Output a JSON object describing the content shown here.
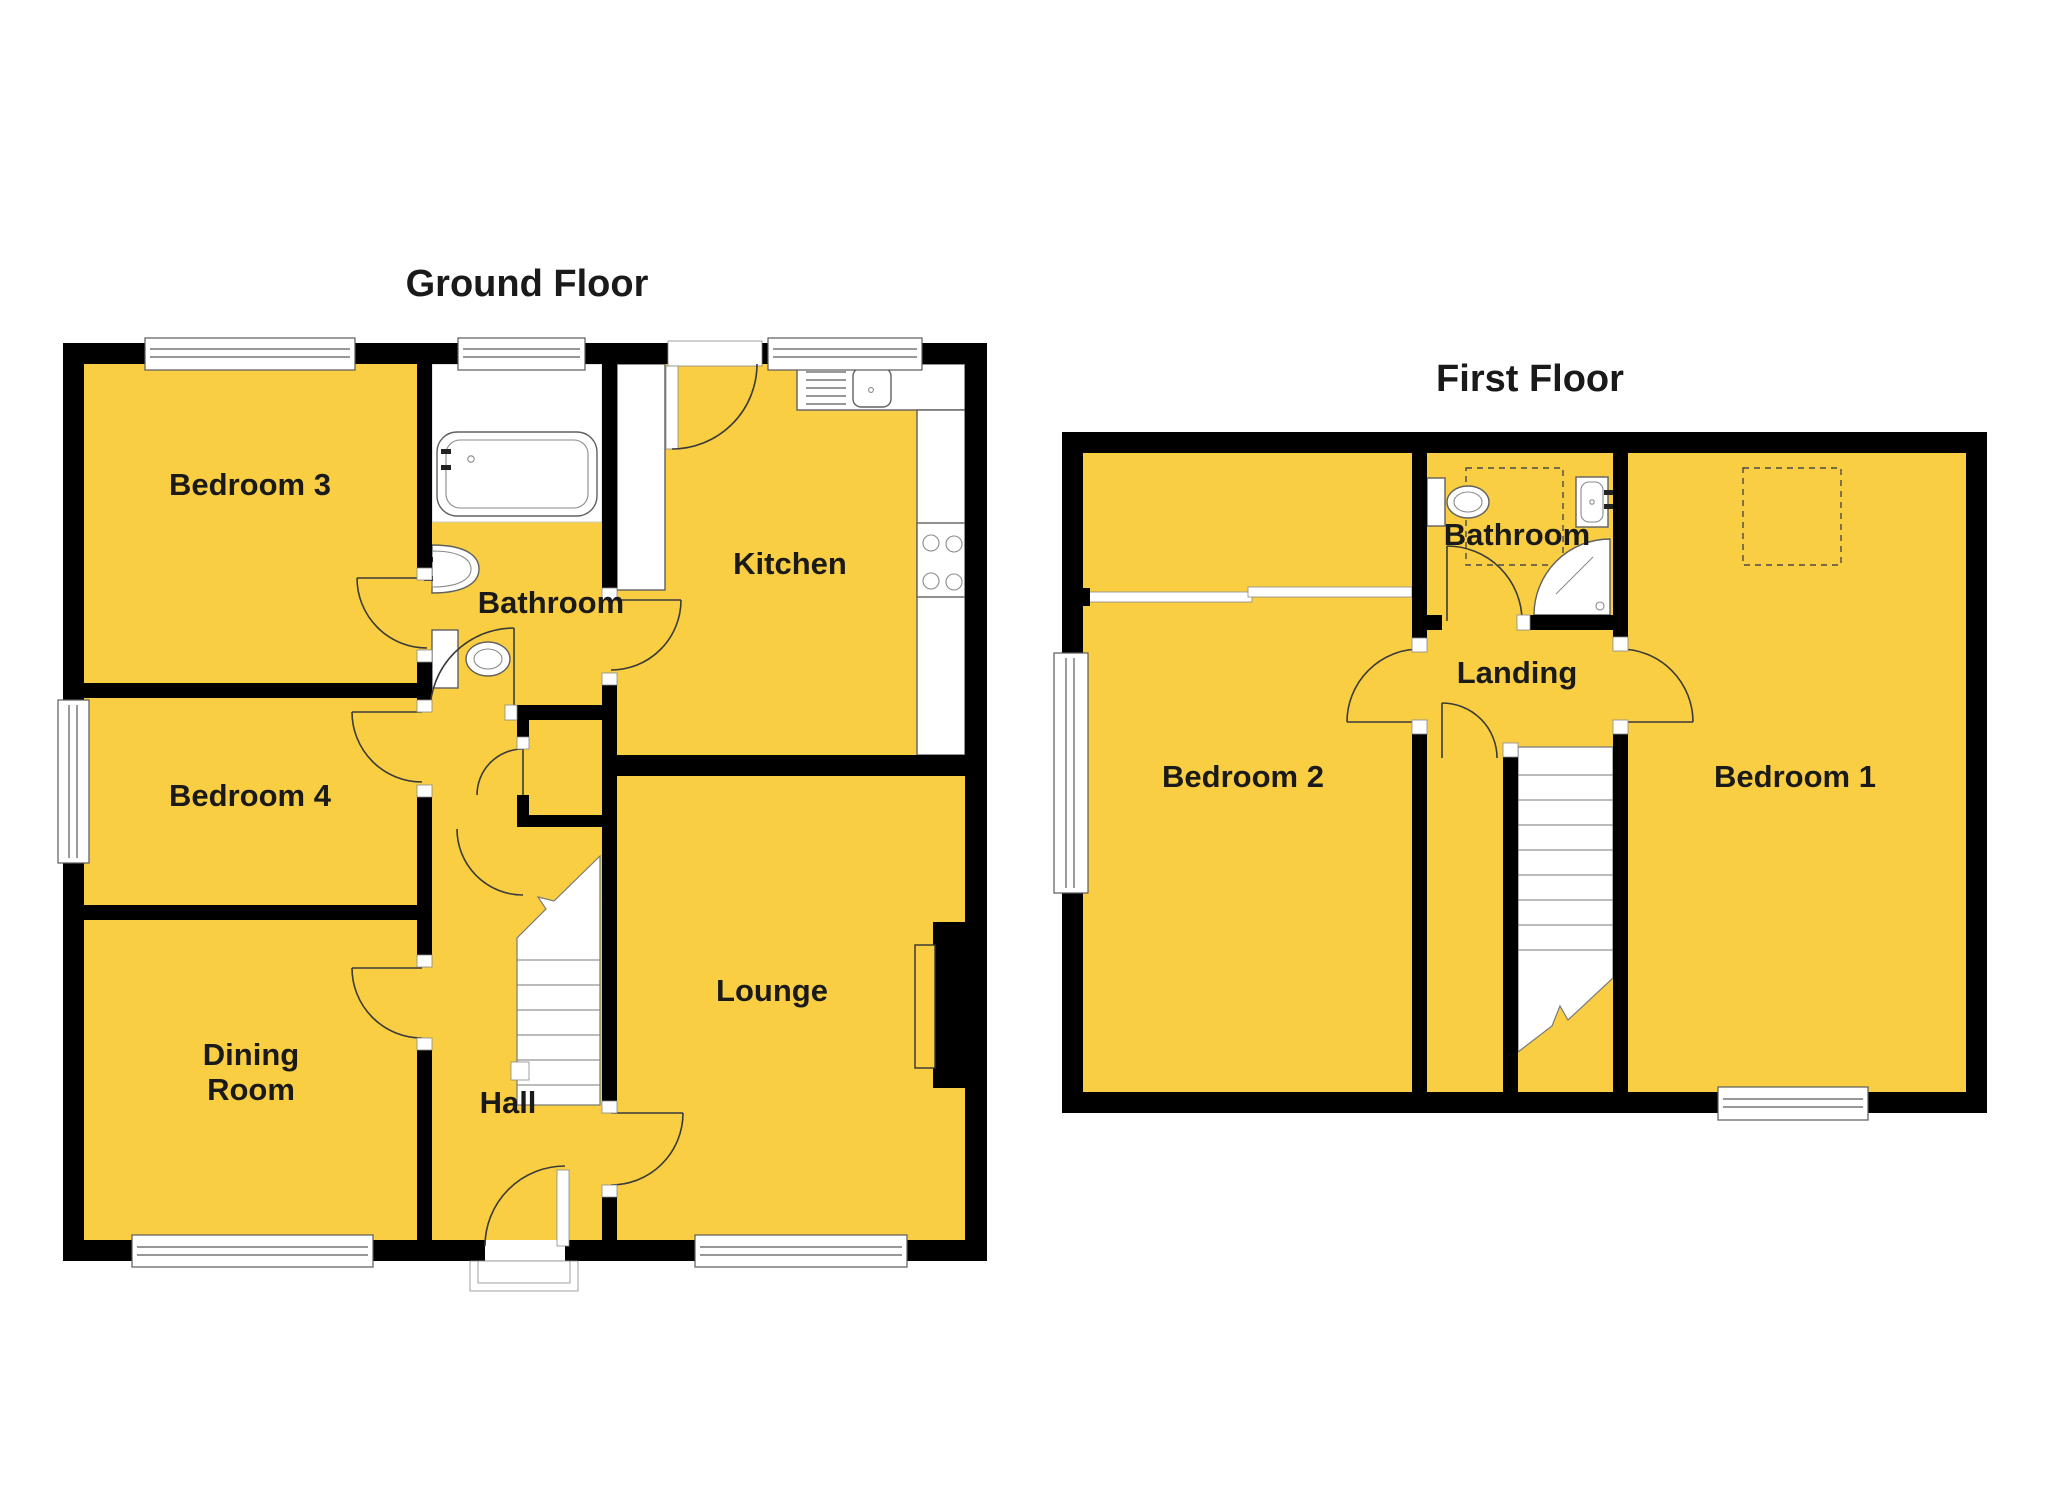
{
  "document": {
    "type_label": "residential floor plan",
    "background_color": "#FFFFFF",
    "room_fill_color": "#F9CE42",
    "wall_color": "#000000",
    "label_color": "#1A1A1A"
  },
  "ground_floor": {
    "title": "Ground Floor",
    "labels": {
      "bedroom3": "Bedroom 3",
      "bathroom": "Bathroom",
      "kitchen": "Kitchen",
      "bedroom4": "Bedroom 4",
      "dining_line1": "Dining",
      "dining_line2": "Room",
      "hall": "Hall",
      "lounge": "Lounge"
    },
    "fixtures": [
      "bath",
      "wash-basin",
      "toilet",
      "kitchen-sink-drainer",
      "hob",
      "worktops",
      "stairs-up",
      "under-stairs-cupboard",
      "fireplace",
      "front-door",
      "back-door"
    ],
    "window_count": 6
  },
  "first_floor": {
    "title": "First Floor",
    "labels": {
      "bedroom2": "Bedroom 2",
      "bathroom": "Bathroom",
      "landing": "Landing",
      "bedroom1": "Bedroom 1"
    },
    "fixtures": [
      "toilet",
      "wash-basin",
      "corner-shower",
      "stairs-down",
      "wardrobe-dashed-outline",
      "airing-cupboard-dashed-outline"
    ],
    "window_count": 2
  }
}
